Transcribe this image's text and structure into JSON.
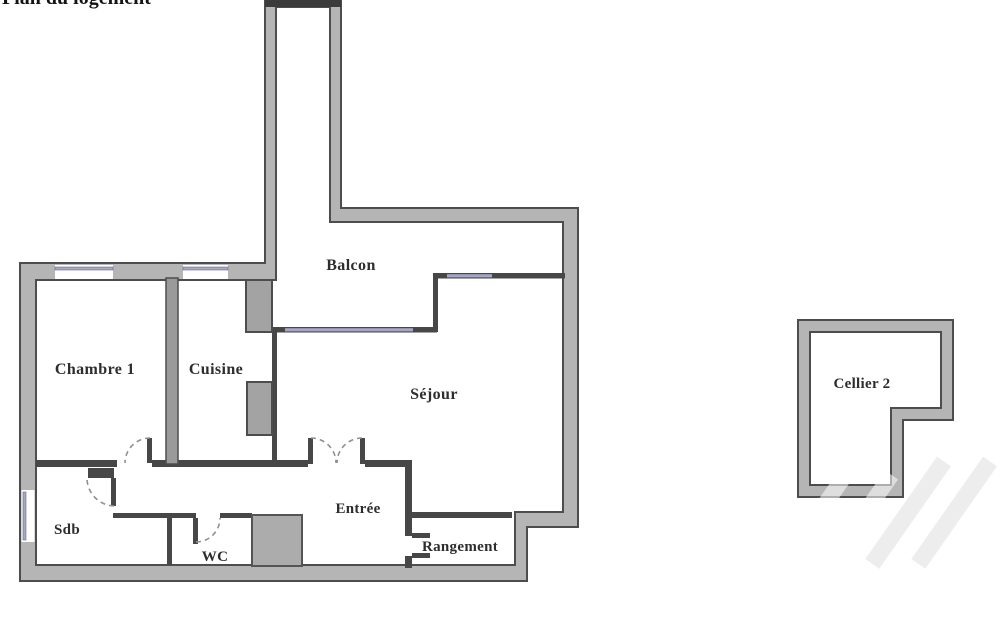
{
  "cropped_title": "Plan du logement",
  "rooms": {
    "chambre1": "Chambre 1",
    "cuisine": "Cuisine",
    "balcon": "Balcon",
    "sejour": "Séjour",
    "sdb": "Sdb",
    "wc": "WC",
    "entree": "Entrée",
    "rangement": "Rangement",
    "cellier": "Cellier 2"
  },
  "colors": {
    "wall_fill": "#b5b5b5",
    "wall_edge": "#4d4d4d",
    "thin_wall": "#474747",
    "window_glazing": "#a6a6c6",
    "duct_fill": "#a3a3a3",
    "shaft_cap": "#3b3b3b",
    "door_arc": "#909090",
    "label_text": "#2d2d2d",
    "background": "#ffffff"
  }
}
